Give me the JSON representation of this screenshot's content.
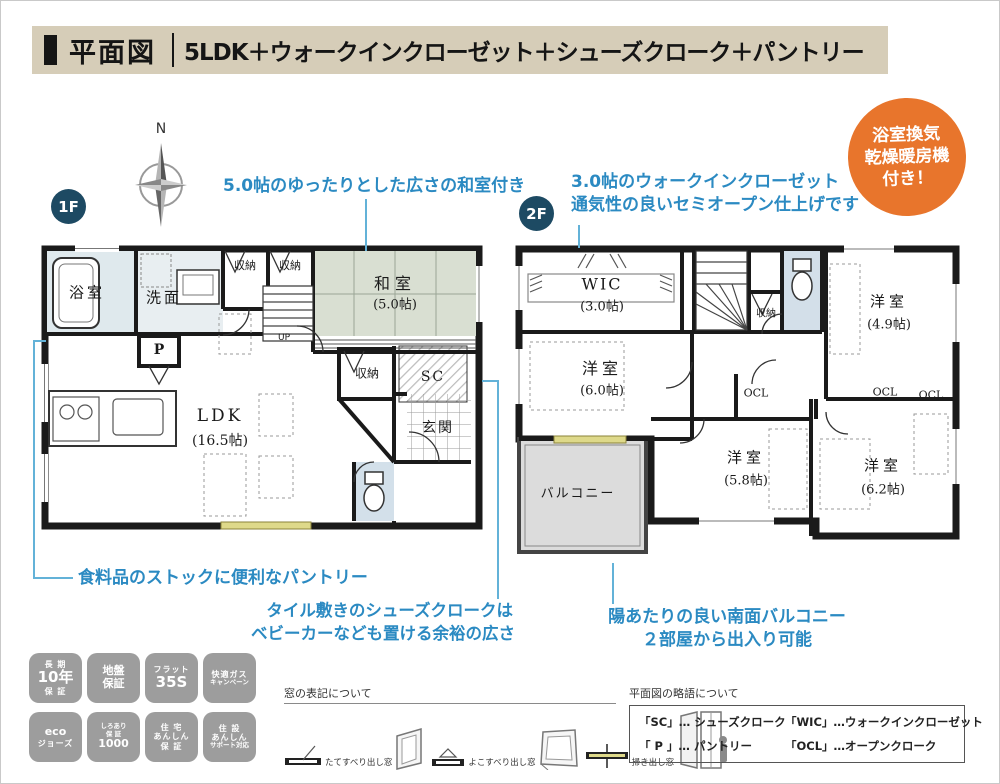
{
  "header": {
    "title": "平面図",
    "subtitle": "5LDK＋ウォークインクローゼット＋シューズクローク＋パントリー"
  },
  "orange_badge": {
    "line1": "浴室換気",
    "line2": "乾燥暖房機",
    "line3": "付き！"
  },
  "compass": {
    "label": "N"
  },
  "floors": {
    "f1": "1F",
    "f2": "2F"
  },
  "annotations": {
    "washitsu": "5.0帖のゆったりとした広さの和室付き",
    "wic_line1": "3.0帖のウォークインクローゼット",
    "wic_line2": "通気性の良いセミオープン仕上げです",
    "pantry": "食料品のストックに便利なパントリー",
    "sc_line1": "タイル敷きのシューズクロークは",
    "sc_line2": "ベビーカーなども置ける余裕の広さ",
    "balcony_line1": "陽あたりの良い南面バルコニー",
    "balcony_line2": "２部屋から出入り可能"
  },
  "rooms1f": {
    "bath": "浴室",
    "wash": "洗面",
    "closet1": "収納",
    "closet2": "収納",
    "washitsu": "和室",
    "washitsu_size": "(5.0帖)",
    "up": "UP",
    "pantry": "P",
    "closet3": "収納",
    "sc": "SC",
    "entrance": "玄関",
    "ldk": "LDK",
    "ldk_size": "(16.5帖)"
  },
  "rooms2f": {
    "wic": "WIC",
    "wic_size": "(3.0帖)",
    "closet": "収納",
    "room60": "洋室",
    "room60_size": "(6.0帖)",
    "room49": "洋室",
    "room49_size": "(4.9帖)",
    "room58": "洋室",
    "room58_size": "(5.8帖)",
    "room62": "洋室",
    "room62_size": "(6.2帖)",
    "ocl1": "OCL",
    "ocl2": "OCL",
    "ocl3": "OCL",
    "balcony": "バルコニー"
  },
  "badges": {
    "items": [
      {
        "l1": "長 期",
        "l2": "10年",
        "l3": "保 証"
      },
      {
        "l1": "地盤",
        "l2": "保証",
        "l3": ""
      },
      {
        "l1": "フラット",
        "l2": "35S",
        "l3": ""
      },
      {
        "l1": "快適ガス",
        "l2": "キャンペーン",
        "l3": ""
      },
      {
        "l1": "eco",
        "l2": "ジョーズ",
        "l3": ""
      },
      {
        "l1": "しろあり",
        "l2": "保 証",
        "l3": "1000"
      },
      {
        "l1": "住 宅",
        "l2": "あんしん",
        "l3": "保 証"
      },
      {
        "l1": "住 設",
        "l2": "あんしん",
        "l3": "サポート対応"
      }
    ]
  },
  "window_legend": {
    "title": "窓の表記について",
    "item1": "たてすべり出し窓",
    "item2": "よこすべり出し窓",
    "item3": "掃き出し窓"
  },
  "abbr_legend": {
    "title": "平面図の略語について",
    "line1a": "「SC」… シューズクローク",
    "line1b": "「WIC」…ウォークインクローゼット",
    "line2a": "「 P 」… パントリー",
    "line2b": "「OCL」…オープンクローク"
  },
  "colors": {
    "header_bg": "#d6cdb8",
    "orange": "#e8752c",
    "note_blue": "#2b8ac2",
    "floor_badge_navy": "#1d4a63",
    "tatami": "#d9dfd2",
    "wall": "#1a1a1a",
    "balcony_gray": "#dcdcdc",
    "badge_gray": "#9d9d9d",
    "window_yellow": "#ded98a"
  }
}
